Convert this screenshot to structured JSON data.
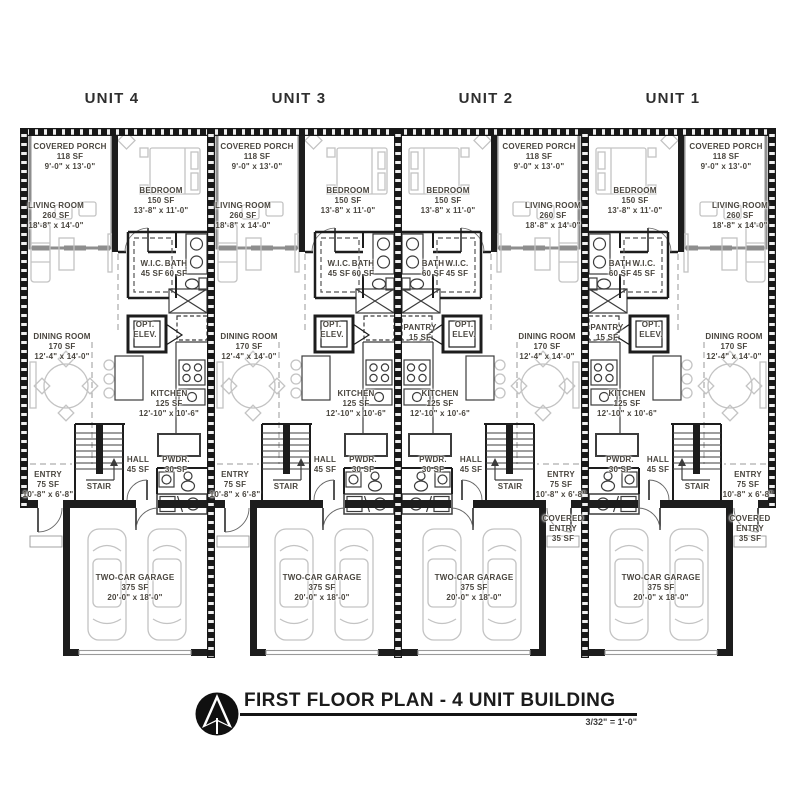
{
  "sheet": {
    "background": "#ffffff"
  },
  "units": [
    {
      "id": "unit-4",
      "label": "UNIT 4"
    },
    {
      "id": "unit-3",
      "label": "UNIT 3"
    },
    {
      "id": "unit-2",
      "label": "UNIT 2"
    },
    {
      "id": "unit-1",
      "label": "UNIT 1"
    }
  ],
  "rooms": {
    "covered_porch": {
      "lines": [
        "COVERED PORCH",
        "118 SF",
        "9'-0\" x 13'-0\""
      ]
    },
    "bedroom": {
      "lines": [
        "BEDROOM",
        "150 SF",
        "13'-8\" x 11'-0\""
      ]
    },
    "living_room": {
      "lines": [
        "LIVING ROOM",
        "260 SF",
        "18'-8\" x 14'-0\""
      ]
    },
    "wic": {
      "lines": [
        "W.I.C.",
        "45 SF"
      ]
    },
    "bath": {
      "lines": [
        "BATH",
        "60 SF"
      ]
    },
    "opt_elev": {
      "lines": [
        "OPT.",
        "ELEV."
      ]
    },
    "pantry": {
      "lines": [
        "PANTRY",
        "15 SF"
      ]
    },
    "dining_room": {
      "lines": [
        "DINING ROOM",
        "170 SF",
        "12'-4\" x 14'-0\""
      ]
    },
    "kitchen": {
      "lines": [
        "KITCHEN",
        "125 SF",
        "12'-10\" x 10'-6\""
      ]
    },
    "hall": {
      "lines": [
        "HALL",
        "45 SF"
      ]
    },
    "pwdr": {
      "lines": [
        "PWDR.",
        "30 SF"
      ]
    },
    "entry": {
      "lines": [
        "ENTRY",
        "75 SF",
        "10'-8\" x 6'-8\""
      ]
    },
    "stair": {
      "lines": [
        "STAIR"
      ]
    },
    "covered_entry": {
      "lines": [
        "COVERED",
        "ENTRY",
        "35 SF"
      ]
    },
    "garage": {
      "lines": [
        "TWO-CAR GARAGE",
        "375 SF",
        "20'-0\" x 18'-0\""
      ]
    }
  },
  "title_block": {
    "title": "FIRST FLOOR PLAN - 4 UNIT BUILDING",
    "scale": "3/32\" = 1'-0\"",
    "north_arrow_icon": "north-arrow"
  },
  "colors": {
    "wall": "#1d1d1d",
    "porch_wall": "#8e8e8e",
    "furniture": "#c3c3c3",
    "fixture": "#3c3c3c",
    "label_text": "#4a463f",
    "title_text": "#1b1b1b"
  }
}
